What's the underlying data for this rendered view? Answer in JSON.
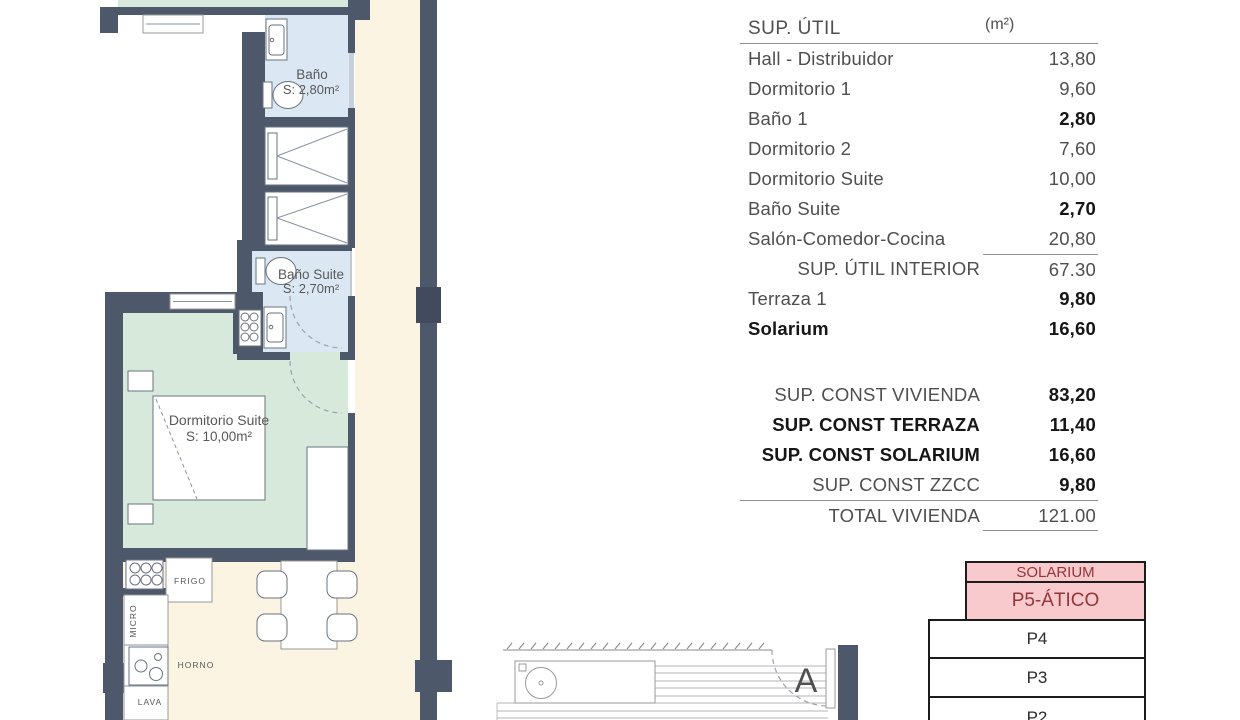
{
  "plan": {
    "rooms": [
      {
        "name": "Baño",
        "area": "S: 2,80m²"
      },
      {
        "name": "Baño Suite",
        "area": "S: 2,70m²"
      },
      {
        "name": "Dormitorio Suite",
        "area": "S: 10,00m²"
      }
    ],
    "kitchen": {
      "frigo": "FRIGO",
      "micro": "MICRO",
      "horno": "HORNO",
      "lava": "LAVA"
    },
    "section_marker": "A"
  },
  "surface_table": {
    "title": "SUP. ÚTIL",
    "unit": "(m²)",
    "rows": [
      {
        "label": "Hall - Distribuidor",
        "value": "13,80"
      },
      {
        "label": "Dormitorio 1",
        "value": "9,60"
      },
      {
        "label": "Baño 1",
        "value": "2,80"
      },
      {
        "label": "Dormitorio 2",
        "value": "7,60"
      },
      {
        "label": "Dormitorio Suite",
        "value": "10,00"
      },
      {
        "label": "Baño Suite",
        "value": "2,70"
      },
      {
        "label": "Salón-Comedor-Cocina",
        "value": "20,80"
      },
      {
        "label": "SUP. ÚTIL INTERIOR",
        "value": "67.30"
      },
      {
        "label": "Terraza 1",
        "value": "9,80"
      },
      {
        "label": "Solarium",
        "value": "16,60"
      }
    ],
    "summary": [
      {
        "label": "SUP. CONST VIVIENDA",
        "value": "83,20"
      },
      {
        "label": "SUP. CONST TERRAZA",
        "value": "11,40"
      },
      {
        "label": "SUP. CONST SOLARIUM",
        "value": "16,60"
      },
      {
        "label": "SUP. CONST ZZCC",
        "value": "9,80"
      }
    ],
    "total": {
      "label": "TOTAL VIVIENDA",
      "value": "121.00"
    }
  },
  "floor_stack": {
    "levels": [
      {
        "label": "SOLARIUM"
      },
      {
        "label": "P5-ÁTICO"
      },
      {
        "label": "P4"
      },
      {
        "label": "P3"
      },
      {
        "label": "P2"
      }
    ]
  },
  "colors": {
    "wall": "#4d586b",
    "bath": "#dbe8f4",
    "bedroom": "#d7e9da",
    "floor": "#fcf4e2",
    "stack_pink": "#f8c9cd",
    "stack_text_red": "#93363a"
  }
}
